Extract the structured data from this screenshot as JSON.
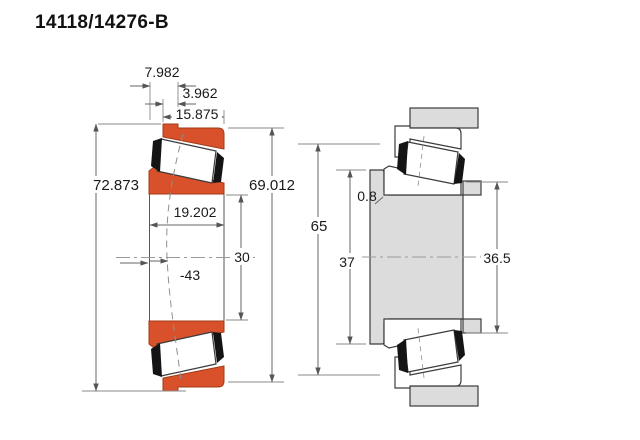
{
  "title": "14118/14276-B",
  "colors": {
    "bearing_fill": "#d8512b",
    "steel_fill": "#dcdcdc",
    "cage_fill": "#141414",
    "outline": "#3c3c3c",
    "dimension_line": "#666666",
    "text": "#1a1a1a",
    "background": "#ffffff"
  },
  "left_view": {
    "dimensions": {
      "outer_width": "7.982",
      "flange_width": "3.962",
      "cup_width": "15.875",
      "flange_diameter": "72.873",
      "outer_diameter": "69.012",
      "total_width": "19.202",
      "bore_diameter": "30",
      "inner_ref": "-43"
    }
  },
  "right_view": {
    "dimensions": {
      "housing_abutment_diameter": "65",
      "shaft_shoulder_diameter": "37",
      "fillet_radius": "0.8",
      "shaft_abutment_diameter": "36.5"
    }
  }
}
